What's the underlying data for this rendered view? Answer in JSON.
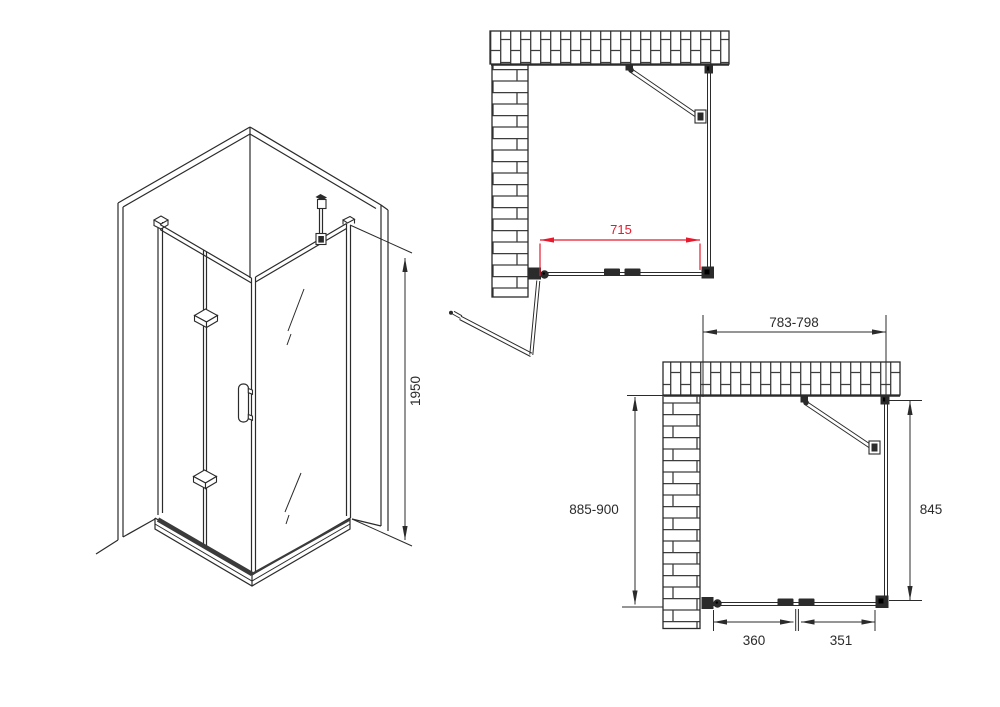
{
  "drawing": {
    "type": "corner-shower-enclosure-technical-drawing",
    "colors": {
      "line": "#2b2b2b",
      "brick_joint": "#3d3d3d",
      "dimension_red": "#e8192c",
      "background": "#ffffff"
    },
    "isometric_view": {
      "height_dim": "1950"
    },
    "plan_view_top": {
      "width_dim": "715"
    },
    "plan_view_bottom": {
      "width_dim": "783-798",
      "depth_dim": "885-900",
      "side_dim": "845",
      "door_panel_left_dim": "360",
      "door_panel_right_dim": "351"
    }
  }
}
